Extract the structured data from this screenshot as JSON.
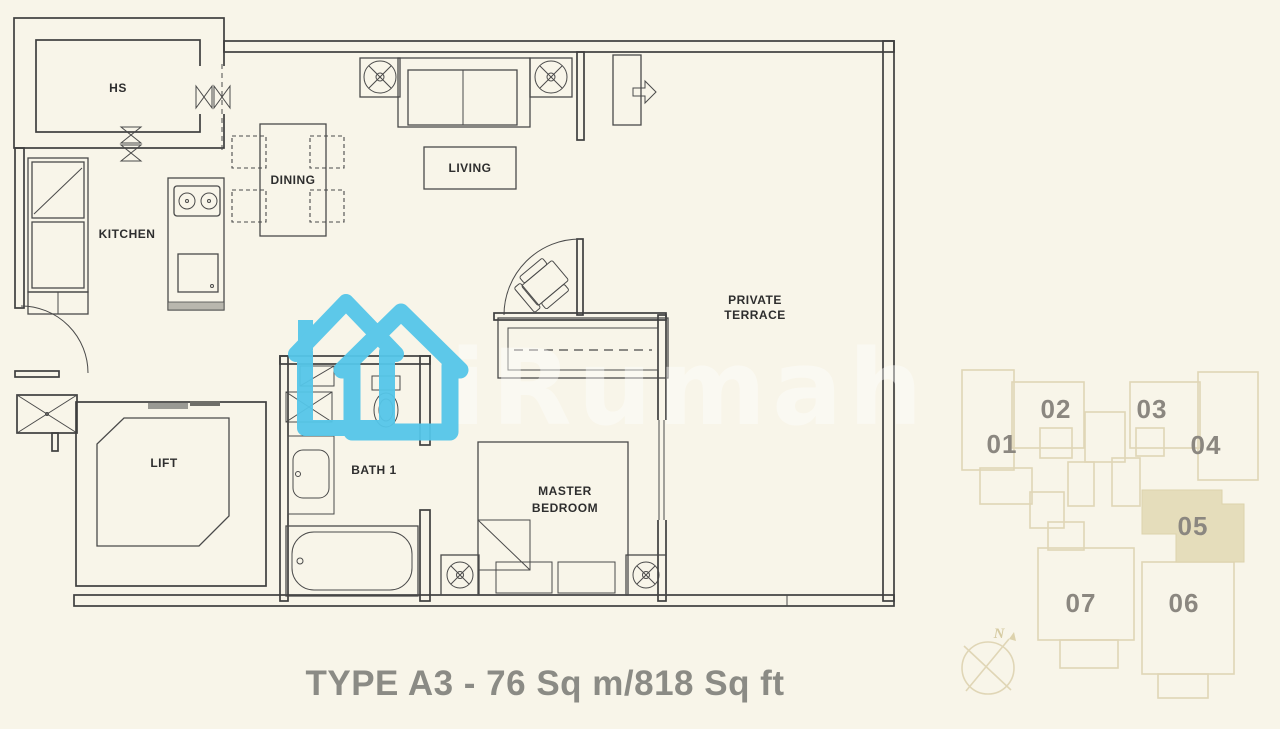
{
  "title": "TYPE A3 - 76 Sq m/818 Sq ft",
  "floor_plan": {
    "rooms": {
      "hs": "HS",
      "kitchen": "KITCHEN",
      "dining": "DINING",
      "living": "LIVING",
      "private_terrace": [
        "PRIVATE",
        "TERRACE"
      ],
      "lift": "LIFT",
      "bath1": "BATH 1",
      "master_bedroom": [
        "MASTER",
        "BEDROOM"
      ]
    }
  },
  "watermark": {
    "brand": "iRumah",
    "house_icon_color": "#55c6e9"
  },
  "key_plan": {
    "units": [
      "01",
      "02",
      "03",
      "04",
      "05",
      "06",
      "07"
    ],
    "highlighted_unit": "05",
    "highlight_color": "#e5ddbb",
    "line_color": "#e0d6b6",
    "text_color": "#8b8780",
    "compass_label": "N"
  },
  "colors": {
    "background": "#f8f5e9",
    "wall_line": "#3f3f3f",
    "title_text": "#8b8b85"
  }
}
